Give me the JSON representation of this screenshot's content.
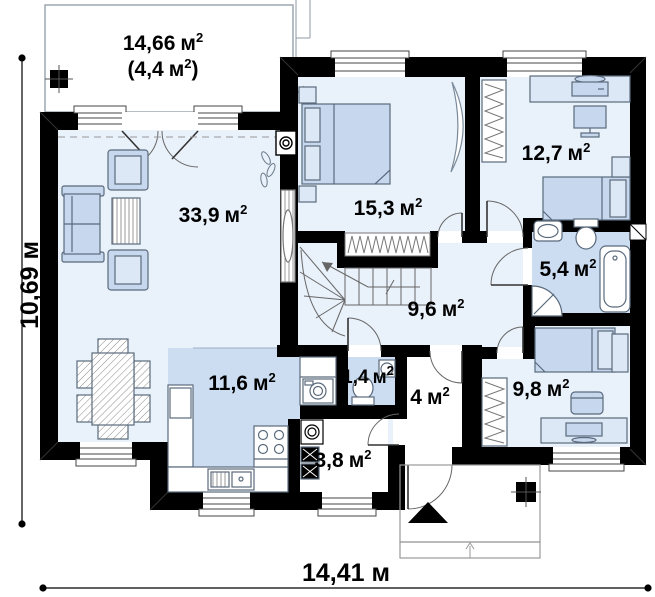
{
  "document": {
    "kind": "floor-plan"
  },
  "colors": {
    "wall": "#000000",
    "floor_light": "#e9f1fa",
    "floor_accent": "#cdddf1",
    "furniture": "#c7d8ee",
    "furniture_light": "#dde8f6",
    "outline": "#5a6a7c"
  },
  "rooms": {
    "terrace": {
      "value": "14,66",
      "unit": "м",
      "sup": "2",
      "value2": "(4,4",
      "unit2": "м",
      "sup2": "2",
      "close2": ")"
    },
    "living": {
      "value": "33,9",
      "unit": "м",
      "sup": "2"
    },
    "bedroom1": {
      "value": "15,3",
      "unit": "м",
      "sup": "2"
    },
    "bedroom2": {
      "value": "12,7",
      "unit": "м",
      "sup": "2"
    },
    "bathroom": {
      "value": "5,4",
      "unit": "м",
      "sup": "2"
    },
    "hall": {
      "value": "9,6",
      "unit": "м",
      "sup": "2"
    },
    "kitchen": {
      "value": "11,6",
      "unit": "м",
      "sup": "2"
    },
    "wc": {
      "value": "1,4",
      "unit": "м",
      "sup": "2"
    },
    "entry": {
      "value": "4",
      "unit": "м",
      "sup": "2"
    },
    "boiler": {
      "value": "3,8",
      "unit": "м",
      "sup": "2"
    },
    "bedroom3": {
      "value": "9,8",
      "unit": "м",
      "sup": "2"
    }
  },
  "dimensions": {
    "width": {
      "value": "14,41",
      "unit": "м"
    },
    "height": {
      "value": "10,69",
      "unit": "м"
    }
  }
}
